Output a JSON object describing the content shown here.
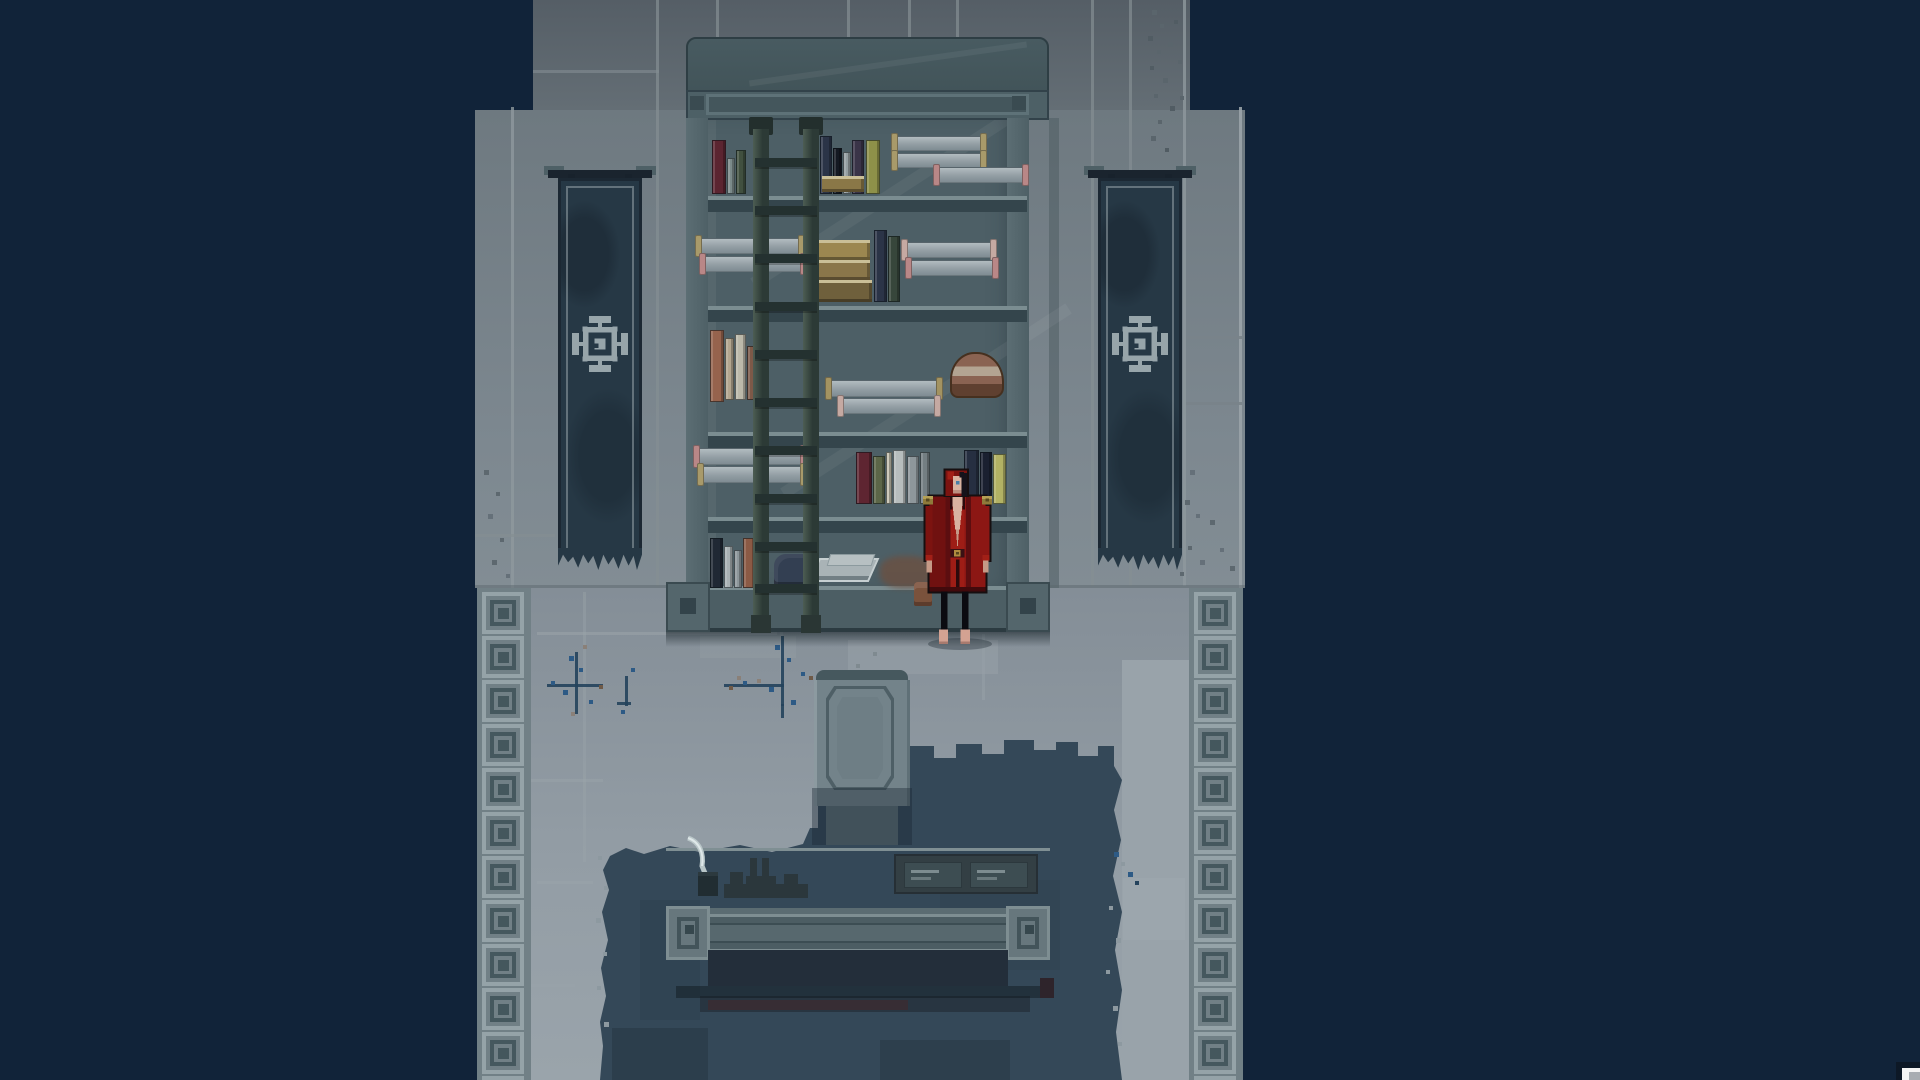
{
  "scene": {
    "type": "pixel-art game scene",
    "setting": "stone archive room with scroll shelf, wall banners, writing desk and red-robed figure",
    "visible_text": "none"
  },
  "palette": {
    "bg": "#112339",
    "wallTop": "#555e66",
    "wall": "#747f86",
    "wallLine": "#848e93",
    "floor": "#8a949c",
    "floorLight": "#99a3aa",
    "tileLight": "#95a3a8",
    "tileDark": "#45585e",
    "stain": "#344858",
    "stainDark": "#2b3c4a",
    "shelf": "#4d5f66",
    "shelfFrame": "#54666c",
    "boardDark": "#34454c",
    "ladder": "#2c3a36",
    "banner": "#263845",
    "emblem": "#97a5aa",
    "desk": "#66767c",
    "deskShadow": "#232e3a",
    "robe": "#8c1714",
    "robeDark": "#5c0e10",
    "robeBright": "#a22017",
    "skin": "#d9b3a0",
    "gold": "#8f7b3a",
    "crackBlue": "#2d5a85"
  },
  "floor": {
    "tile_count": 12
  },
  "banners": {
    "count": 2,
    "emblem": "square-gear sigil",
    "condition": "tattered"
  },
  "shelf": {
    "rows": 5,
    "boards": [
      196,
      306,
      432,
      517
    ],
    "ladder": {
      "rungs": [
        158,
        206,
        254,
        302,
        350,
        398,
        446,
        494,
        542,
        584
      ]
    },
    "items": [
      {
        "t": "book",
        "x": 712,
        "y": 140,
        "w": 14,
        "h": 54,
        "c": "#5b2531"
      },
      {
        "t": "book",
        "x": 727,
        "y": 158,
        "w": 8,
        "h": 36,
        "c": "#7b8a8a"
      },
      {
        "t": "book",
        "x": 736,
        "y": 150,
        "w": 10,
        "h": 44,
        "c": "#41503f"
      },
      {
        "t": "book",
        "x": 820,
        "y": 136,
        "w": 12,
        "h": 58,
        "c": "#2b3447"
      },
      {
        "t": "book",
        "x": 833,
        "y": 148,
        "w": 9,
        "h": 46,
        "c": "#141922"
      },
      {
        "t": "book",
        "x": 843,
        "y": 152,
        "w": 8,
        "h": 42,
        "c": "#949ea1"
      },
      {
        "t": "book",
        "x": 852,
        "y": 140,
        "w": 12,
        "h": 54,
        "c": "#3a3448"
      },
      {
        "t": "gbook",
        "x": 822,
        "y": 176,
        "w": 42,
        "h": 16,
        "c": "#8a7747"
      },
      {
        "t": "book",
        "x": 866,
        "y": 140,
        "w": 14,
        "h": 54,
        "c": "#8e9149"
      },
      {
        "t": "scroll",
        "x": 896,
        "y": 136,
        "w": 86,
        "h": 15,
        "cap": "#a89a6a"
      },
      {
        "t": "scroll",
        "x": 896,
        "y": 153,
        "w": 86,
        "h": 15,
        "cap": "#a89a6a"
      },
      {
        "t": "scroll",
        "x": 938,
        "y": 167,
        "w": 86,
        "h": 16,
        "cap": "#b98787"
      },
      {
        "t": "scroll",
        "x": 700,
        "y": 238,
        "w": 100,
        "h": 16,
        "cap": "#a89a6a"
      },
      {
        "t": "scroll",
        "x": 704,
        "y": 256,
        "w": 98,
        "h": 16,
        "cap": "#b98787"
      },
      {
        "t": "gbook",
        "x": 812,
        "y": 240,
        "w": 58,
        "h": 20,
        "c": "#9c8750"
      },
      {
        "t": "gbook",
        "x": 816,
        "y": 260,
        "w": 54,
        "h": 20,
        "c": "#8a764a"
      },
      {
        "t": "gbook",
        "x": 812,
        "y": 280,
        "w": 60,
        "h": 22,
        "c": "#6f603c"
      },
      {
        "t": "book",
        "x": 874,
        "y": 230,
        "w": 13,
        "h": 72,
        "c": "#2b3447"
      },
      {
        "t": "book",
        "x": 888,
        "y": 236,
        "w": 12,
        "h": 66,
        "c": "#37463b"
      },
      {
        "t": "scroll",
        "x": 906,
        "y": 242,
        "w": 86,
        "h": 16,
        "cap": "#c5a9a2"
      },
      {
        "t": "scroll",
        "x": 910,
        "y": 260,
        "w": 84,
        "h": 16,
        "cap": "#b98787"
      },
      {
        "t": "book",
        "x": 710,
        "y": 330,
        "w": 14,
        "h": 72,
        "c": "#96634d"
      },
      {
        "t": "book",
        "x": 725,
        "y": 338,
        "w": 9,
        "h": 62,
        "c": "#b3a68f"
      },
      {
        "t": "book",
        "x": 735,
        "y": 334,
        "w": 11,
        "h": 66,
        "c": "#bcb9aa"
      },
      {
        "t": "book",
        "x": 747,
        "y": 346,
        "w": 10,
        "h": 54,
        "c": "#7d5948"
      },
      {
        "t": "scroll",
        "x": 830,
        "y": 380,
        "w": 108,
        "h": 17,
        "cap": "#a39361"
      },
      {
        "t": "scroll",
        "x": 842,
        "y": 398,
        "w": 94,
        "h": 16,
        "cap": "#c5a9a2"
      },
      {
        "t": "stack",
        "x": 950,
        "y": 352,
        "w": 54,
        "h": 46
      },
      {
        "t": "scroll",
        "x": 698,
        "y": 448,
        "w": 104,
        "h": 17,
        "cap": "#b98787"
      },
      {
        "t": "scroll",
        "x": 702,
        "y": 466,
        "w": 100,
        "h": 17,
        "cap": "#a89a6a"
      },
      {
        "t": "book",
        "x": 856,
        "y": 452,
        "w": 16,
        "h": 52,
        "c": "#5e2531"
      },
      {
        "t": "book",
        "x": 873,
        "y": 456,
        "w": 12,
        "h": 48,
        "c": "#5c6648"
      },
      {
        "t": "book",
        "x": 886,
        "y": 452,
        "w": 6,
        "h": 52,
        "c": "#c5c0ae"
      },
      {
        "t": "book",
        "x": 893,
        "y": 450,
        "w": 13,
        "h": 54,
        "c": "#b7bdbd"
      },
      {
        "t": "book",
        "x": 907,
        "y": 456,
        "w": 12,
        "h": 48,
        "c": "#8e979b"
      },
      {
        "t": "book",
        "x": 920,
        "y": 452,
        "w": 10,
        "h": 52,
        "c": "#747e82"
      },
      {
        "t": "book",
        "x": 964,
        "y": 450,
        "w": 15,
        "h": 54,
        "c": "#262f41"
      },
      {
        "t": "book",
        "x": 980,
        "y": 452,
        "w": 12,
        "h": 52,
        "c": "#1a2030"
      },
      {
        "t": "book",
        "x": 993,
        "y": 454,
        "w": 13,
        "h": 50,
        "c": "#b2b264"
      },
      {
        "t": "book",
        "x": 710,
        "y": 538,
        "w": 13,
        "h": 50,
        "c": "#202834"
      },
      {
        "t": "book",
        "x": 724,
        "y": 546,
        "w": 9,
        "h": 42,
        "c": "#a9b1b3"
      },
      {
        "t": "book",
        "x": 734,
        "y": 550,
        "w": 8,
        "h": 38,
        "c": "#8d969a"
      },
      {
        "t": "book",
        "x": 743,
        "y": 538,
        "w": 12,
        "h": 50,
        "c": "#8b5a45"
      },
      {
        "t": "book",
        "x": 756,
        "y": 548,
        "w": 9,
        "h": 40,
        "c": "#6d4a3c"
      },
      {
        "t": "cloth",
        "x": 774,
        "y": 554,
        "w": 42,
        "h": 34
      },
      {
        "t": "papers",
        "x": 814,
        "y": 558,
        "w": 60,
        "h": 24
      },
      {
        "t": "smear",
        "x": 880,
        "y": 556,
        "w": 52,
        "h": 32
      },
      {
        "t": "figure",
        "x": 914,
        "y": 582,
        "w": 18,
        "h": 24
      }
    ]
  },
  "marks": {
    "wall": [
      [
        511,
        107,
        3,
        481,
        "#8f989d",
        0.8
      ],
      [
        1239,
        107,
        3,
        481,
        "#9aa3a8",
        0.9
      ],
      [
        656,
        0,
        3,
        586,
        "#848e93",
        0.7
      ],
      [
        716,
        0,
        3,
        586,
        "#848e93",
        0.7
      ],
      [
        847,
        0,
        3,
        104,
        "#848e93",
        0.7
      ],
      [
        908,
        0,
        3,
        104,
        "#848e93",
        0.7
      ],
      [
        956,
        0,
        3,
        104,
        "#848e93",
        0.7
      ],
      [
        1091,
        0,
        3,
        586,
        "#848e93",
        0.7
      ],
      [
        1129,
        0,
        3,
        586,
        "#848e93",
        0.7
      ],
      [
        1183,
        0,
        3,
        586,
        "#8f989d",
        0.8
      ],
      [
        533,
        70,
        126,
        3,
        "#848e93",
        0.6
      ],
      [
        1186,
        336,
        56,
        3,
        "#79838a",
        0.9
      ],
      [
        1186,
        402,
        56,
        3,
        "#79838a",
        0.9
      ],
      [
        475,
        534,
        80,
        3,
        "#848e93",
        0.7
      ],
      [
        1049,
        118,
        10,
        470,
        "#4e5c62",
        0.55
      ],
      [
        1152,
        10,
        5,
        5,
        "#5a656c",
        1
      ],
      [
        1160,
        24,
        4,
        4,
        "#5a656c",
        1
      ],
      [
        1148,
        36,
        5,
        5,
        "#515c63",
        1
      ],
      [
        1157,
        50,
        4,
        4,
        "#5a656c",
        1
      ],
      [
        1168,
        42,
        5,
        5,
        "#5a656c",
        1
      ],
      [
        1150,
        66,
        4,
        4,
        "#515c63",
        1
      ],
      [
        1163,
        78,
        5,
        5,
        "#5a656c",
        1
      ],
      [
        1154,
        94,
        4,
        4,
        "#5a656c",
        1
      ],
      [
        1170,
        106,
        5,
        5,
        "#515c63",
        1
      ],
      [
        1158,
        120,
        4,
        4,
        "#5a656c",
        1
      ],
      [
        1151,
        136,
        5,
        5,
        "#5a656c",
        1
      ],
      [
        1165,
        148,
        4,
        4,
        "#515c63",
        1
      ],
      [
        1174,
        20,
        4,
        4,
        "#515c63",
        1
      ],
      [
        1178,
        60,
        4,
        4,
        "#5a656c",
        1
      ],
      [
        1180,
        96,
        4,
        4,
        "#5a656c",
        1
      ],
      [
        1166,
        446,
        5,
        5,
        "#5d686f",
        1
      ],
      [
        1178,
        458,
        4,
        4,
        "#5d686f",
        1
      ],
      [
        1190,
        470,
        5,
        5,
        "#657079",
        1
      ],
      [
        1172,
        486,
        4,
        4,
        "#5d686f",
        1
      ],
      [
        1185,
        500,
        5,
        5,
        "#5d686f",
        1
      ],
      [
        1196,
        514,
        4,
        4,
        "#657079",
        1
      ],
      [
        1176,
        530,
        5,
        5,
        "#5d686f",
        1
      ],
      [
        1188,
        546,
        4,
        4,
        "#5d686f",
        1
      ],
      [
        1200,
        560,
        5,
        5,
        "#657079",
        1
      ],
      [
        1180,
        572,
        4,
        4,
        "#5d686f",
        1
      ],
      [
        1210,
        520,
        5,
        5,
        "#5d686f",
        1
      ],
      [
        1220,
        548,
        4,
        4,
        "#657079",
        1
      ],
      [
        1230,
        566,
        5,
        5,
        "#5d686f",
        1
      ],
      [
        484,
        470,
        5,
        5,
        "#5d686f",
        1
      ],
      [
        496,
        492,
        4,
        4,
        "#5d686f",
        1
      ],
      [
        488,
        514,
        5,
        5,
        "#657079",
        1
      ],
      [
        500,
        538,
        4,
        4,
        "#5d686f",
        1
      ],
      [
        492,
        560,
        5,
        5,
        "#5d686f",
        1
      ],
      [
        506,
        574,
        4,
        4,
        "#657079",
        1
      ]
    ],
    "floor": [
      [
        475,
        585,
        770,
        3,
        "#5c686e",
        0.5
      ],
      [
        537,
        632,
        240,
        3,
        "#9aa4aa",
        0.55
      ],
      [
        531,
        779,
        72,
        3,
        "#9aa4aa",
        0.5
      ],
      [
        537,
        881,
        56,
        3,
        "#9aa4aa",
        0.5
      ],
      [
        531,
        984,
        44,
        3,
        "#9aa4aa",
        0.5
      ],
      [
        583,
        592,
        3,
        270,
        "#9aa4aa",
        0.4
      ],
      [
        780,
        592,
        3,
        92,
        "#9aa4aa",
        0.45
      ],
      [
        982,
        634,
        3,
        66,
        "#9aa4aa",
        0.45
      ],
      [
        1122,
        686,
        67,
        3,
        "#9aa4aa",
        0.5
      ],
      [
        848,
        640,
        150,
        34,
        "#97a1a7",
        0.55
      ],
      [
        700,
        636,
        96,
        22,
        "#929ca2",
        0.5
      ],
      [
        1123,
        878,
        62,
        62,
        "#a0aab0",
        0.5
      ],
      [
        575,
        652,
        3,
        62,
        "#24425c",
        0.9
      ],
      [
        547,
        684,
        56,
        3,
        "#24425c",
        0.9
      ],
      [
        569,
        656,
        5,
        5,
        "#2d5a85",
        1
      ],
      [
        579,
        668,
        4,
        4,
        "#2d5a85",
        1
      ],
      [
        563,
        690,
        5,
        5,
        "#2d5a85",
        1
      ],
      [
        589,
        700,
        4,
        4,
        "#2d5a85",
        1
      ],
      [
        551,
        681,
        4,
        4,
        "#2d5a85",
        1
      ],
      [
        599,
        685,
        4,
        4,
        "#6f5a48",
        1
      ],
      [
        571,
        712,
        4,
        4,
        "#8a8078",
        1
      ],
      [
        583,
        645,
        4,
        4,
        "#8a8078",
        1
      ],
      [
        781,
        636,
        3,
        70,
        "#24425c",
        0.9
      ],
      [
        724,
        684,
        60,
        3,
        "#24425c",
        0.9
      ],
      [
        781,
        704,
        3,
        14,
        "#24425c",
        0.9
      ],
      [
        775,
        645,
        5,
        5,
        "#2d5a85",
        1
      ],
      [
        787,
        658,
        4,
        4,
        "#2d5a85",
        1
      ],
      [
        769,
        687,
        5,
        5,
        "#2d5a85",
        1
      ],
      [
        743,
        681,
        4,
        4,
        "#2d5a85",
        1
      ],
      [
        729,
        686,
        4,
        4,
        "#6f5a48",
        1
      ],
      [
        757,
        679,
        4,
        4,
        "#8a8078",
        1
      ],
      [
        791,
        700,
        5,
        5,
        "#2d5a85",
        1
      ],
      [
        801,
        672,
        4,
        4,
        "#2d5a85",
        1
      ],
      [
        809,
        676,
        4,
        4,
        "#6f5a48",
        1
      ],
      [
        737,
        676,
        4,
        4,
        "#8a8078",
        1
      ],
      [
        625,
        676,
        3,
        30,
        "#24425c",
        0.9
      ],
      [
        617,
        702,
        14,
        3,
        "#24425c",
        0.9
      ],
      [
        621,
        710,
        4,
        4,
        "#2d5a85",
        1
      ],
      [
        631,
        668,
        4,
        4,
        "#2d5a85",
        1
      ],
      [
        856,
        664,
        4,
        4,
        "#7f8a90",
        1
      ],
      [
        873,
        652,
        4,
        4,
        "#7f8a90",
        1
      ]
    ],
    "stain": [
      [
        612,
        1028,
        96,
        52,
        "#2b3c4a",
        0.8
      ],
      [
        880,
        1040,
        130,
        40,
        "#2c3d4b",
        0.8
      ],
      [
        700,
        996,
        330,
        16,
        "#27333f",
        0.9
      ],
      [
        708,
        1000,
        200,
        10,
        "#3a2c33",
        0.85
      ],
      [
        1040,
        978,
        14,
        20,
        "#2e2027",
        0.9
      ],
      [
        640,
        900,
        60,
        120,
        "#2f4250",
        0.6
      ],
      [
        940,
        880,
        120,
        90,
        "#2f4250",
        0.5
      ]
    ],
    "overlay": [
      [
        1114,
        852,
        5,
        5,
        "#2d5a85",
        1
      ],
      [
        1121,
        862,
        4,
        4,
        "#8d99a0",
        1
      ],
      [
        1128,
        872,
        5,
        5,
        "#2d5a85",
        1
      ],
      [
        1135,
        881,
        4,
        4,
        "#24425c",
        1
      ],
      [
        1109,
        906,
        4,
        4,
        "#8d99a0",
        1
      ],
      [
        1116,
        938,
        5,
        5,
        "#8d99a0",
        1
      ],
      [
        1106,
        970,
        4,
        4,
        "#8d99a0",
        1
      ],
      [
        1113,
        1006,
        5,
        5,
        "#8d99a0",
        1
      ],
      [
        1118,
        1042,
        4,
        4,
        "#8d99a0",
        1
      ],
      [
        598,
        856,
        4,
        4,
        "#8d99a0",
        1
      ],
      [
        604,
        886,
        4,
        4,
        "#8d99a0",
        1
      ],
      [
        596,
        918,
        5,
        5,
        "#8d99a0",
        1
      ],
      [
        603,
        952,
        4,
        4,
        "#8d99a0",
        1
      ],
      [
        597,
        986,
        4,
        4,
        "#8d99a0",
        1
      ],
      [
        604,
        1022,
        5,
        5,
        "#8d99a0",
        1
      ]
    ]
  }
}
